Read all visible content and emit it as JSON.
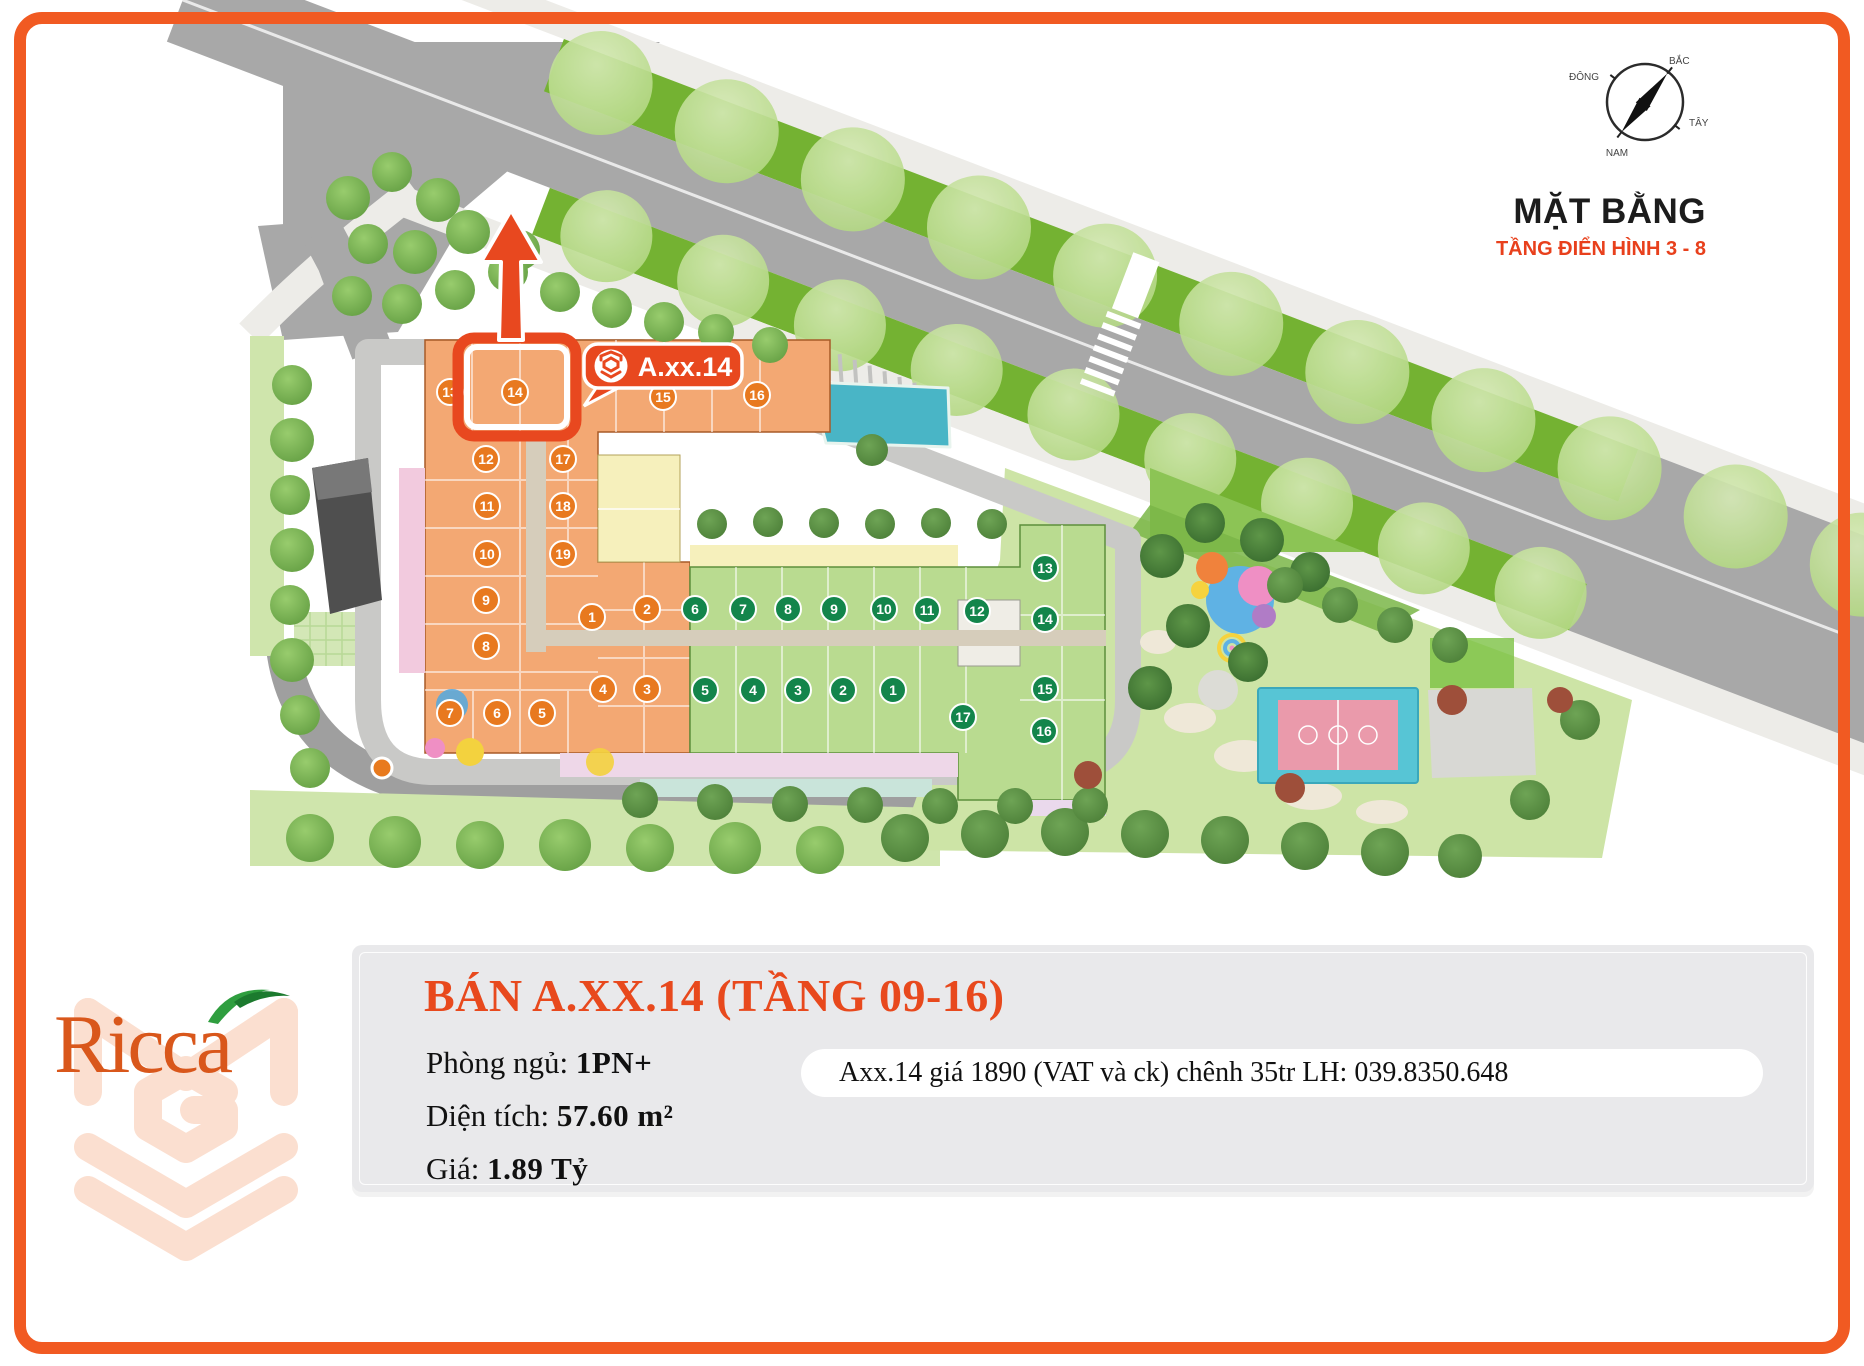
{
  "page": {
    "border_color": "#f15a22",
    "background": "#ffffff"
  },
  "plan": {
    "title": "MẶT BẰNG",
    "subtitle": "TẦNG ĐIỂN HÌNH 3 - 8",
    "compass": {
      "north": "BẮC",
      "south": "NAM",
      "east": "ĐÔNG",
      "west": "TÂY"
    },
    "highlight": {
      "label": "A.xx.14",
      "unit": "14",
      "color": "#e8481f"
    },
    "unit_colors": {
      "orange": "#e8791f",
      "green": "#13854b"
    },
    "orange_units": [
      {
        "n": "13",
        "x": 450,
        "y": 392
      },
      {
        "n": "14",
        "x": 515,
        "y": 392
      },
      {
        "n": "15",
        "x": 663,
        "y": 397
      },
      {
        "n": "16",
        "x": 757,
        "y": 395
      },
      {
        "n": "12",
        "x": 486,
        "y": 459
      },
      {
        "n": "17",
        "x": 563,
        "y": 459
      },
      {
        "n": "11",
        "x": 487,
        "y": 506
      },
      {
        "n": "18",
        "x": 563,
        "y": 506
      },
      {
        "n": "10",
        "x": 487,
        "y": 554
      },
      {
        "n": "19",
        "x": 563,
        "y": 554
      },
      {
        "n": "9",
        "x": 486,
        "y": 600
      },
      {
        "n": "1",
        "x": 592,
        "y": 617
      },
      {
        "n": "2",
        "x": 647,
        "y": 609
      },
      {
        "n": "8",
        "x": 486,
        "y": 646
      },
      {
        "n": "4",
        "x": 603,
        "y": 689
      },
      {
        "n": "3",
        "x": 647,
        "y": 689
      },
      {
        "n": "7",
        "x": 450,
        "y": 713
      },
      {
        "n": "6",
        "x": 497,
        "y": 713
      },
      {
        "n": "5",
        "x": 542,
        "y": 713
      }
    ],
    "green_units": [
      {
        "n": "6",
        "x": 695,
        "y": 609
      },
      {
        "n": "7",
        "x": 743,
        "y": 609
      },
      {
        "n": "8",
        "x": 788,
        "y": 609
      },
      {
        "n": "9",
        "x": 834,
        "y": 609
      },
      {
        "n": "10",
        "x": 884,
        "y": 609
      },
      {
        "n": "11",
        "x": 927,
        "y": 610
      },
      {
        "n": "12",
        "x": 977,
        "y": 611
      },
      {
        "n": "13",
        "x": 1045,
        "y": 568
      },
      {
        "n": "14",
        "x": 1045,
        "y": 619
      },
      {
        "n": "5",
        "x": 705,
        "y": 690
      },
      {
        "n": "4",
        "x": 753,
        "y": 690
      },
      {
        "n": "3",
        "x": 798,
        "y": 690
      },
      {
        "n": "2",
        "x": 843,
        "y": 690
      },
      {
        "n": "1",
        "x": 893,
        "y": 690
      },
      {
        "n": "15",
        "x": 1045,
        "y": 689
      },
      {
        "n": "17",
        "x": 963,
        "y": 717
      },
      {
        "n": "16",
        "x": 1044,
        "y": 731
      }
    ]
  },
  "listing": {
    "heading": "BÁN A.XX.14 (TẦNG 09-16)",
    "fields": [
      {
        "label": "Phòng ngủ:",
        "value": "1PN+"
      },
      {
        "label": "Diện tích:",
        "value": "57.60 m²"
      },
      {
        "label": "Giá:",
        "value": "1.89 Tỷ"
      }
    ],
    "note": "Axx.14 giá 1890 (VAT và ck) chênh 35tr LH: 039.8350.648"
  },
  "logo": {
    "text": "Ricca"
  }
}
